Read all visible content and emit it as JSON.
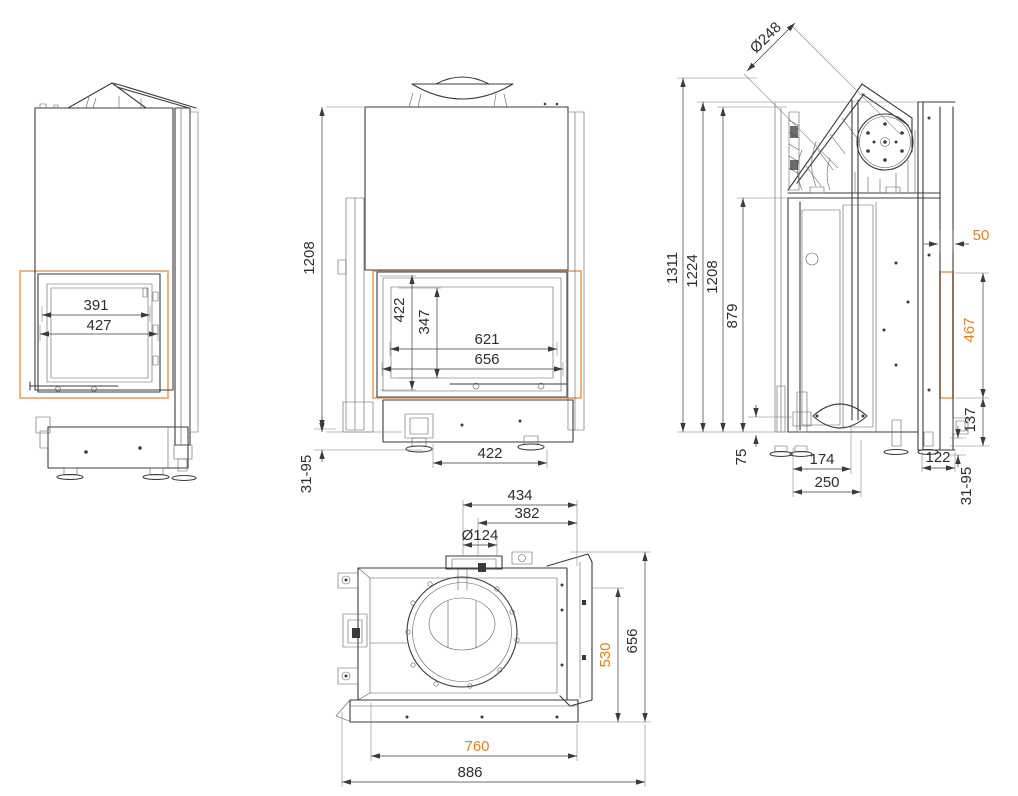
{
  "page": {
    "background": "#ffffff",
    "subject": "fireplace insert dimensional drawing, four orthographic views",
    "units": "mm"
  },
  "colors": {
    "line": "#3b3b3b",
    "dim_text": "#2e2e2e",
    "accent": "#e8801e",
    "highlight": "#f0aa70"
  },
  "views": {
    "left_side": {
      "label": "left side view",
      "dims": {
        "glass_cut_width": "391",
        "glass_frame_width": "427"
      }
    },
    "front": {
      "label": "front view",
      "dims": {
        "body_height": "1208",
        "glass_frame_height": "422",
        "glass_cut_height": "347",
        "glass_cut_width": "621",
        "glass_frame_width": "656",
        "base_width": "422",
        "leveling_feet_range": "31-95"
      }
    },
    "right_side": {
      "label": "right side view",
      "dims": {
        "flue_diameter": "Ø248",
        "total_height": "1311",
        "frame_top_height": "1224",
        "body_height": "1208",
        "shelf_height": "879",
        "plinth_height": "75",
        "duct_offset": "174",
        "duct_depth": "250",
        "frame_depth": "122",
        "leveling_feet_range": "31-95",
        "frame_overhang": "50",
        "side_glass_height": "467",
        "glass_bottom_height": "137"
      }
    },
    "top": {
      "label": "top view",
      "dims": {
        "flue_center_offset": "434",
        "flue_rear_offset": "382",
        "flue_collar_diameter": "Ø124",
        "side_glass_width": "530",
        "total_depth": "656",
        "front_glass_width": "760",
        "total_width": "886"
      }
    }
  }
}
